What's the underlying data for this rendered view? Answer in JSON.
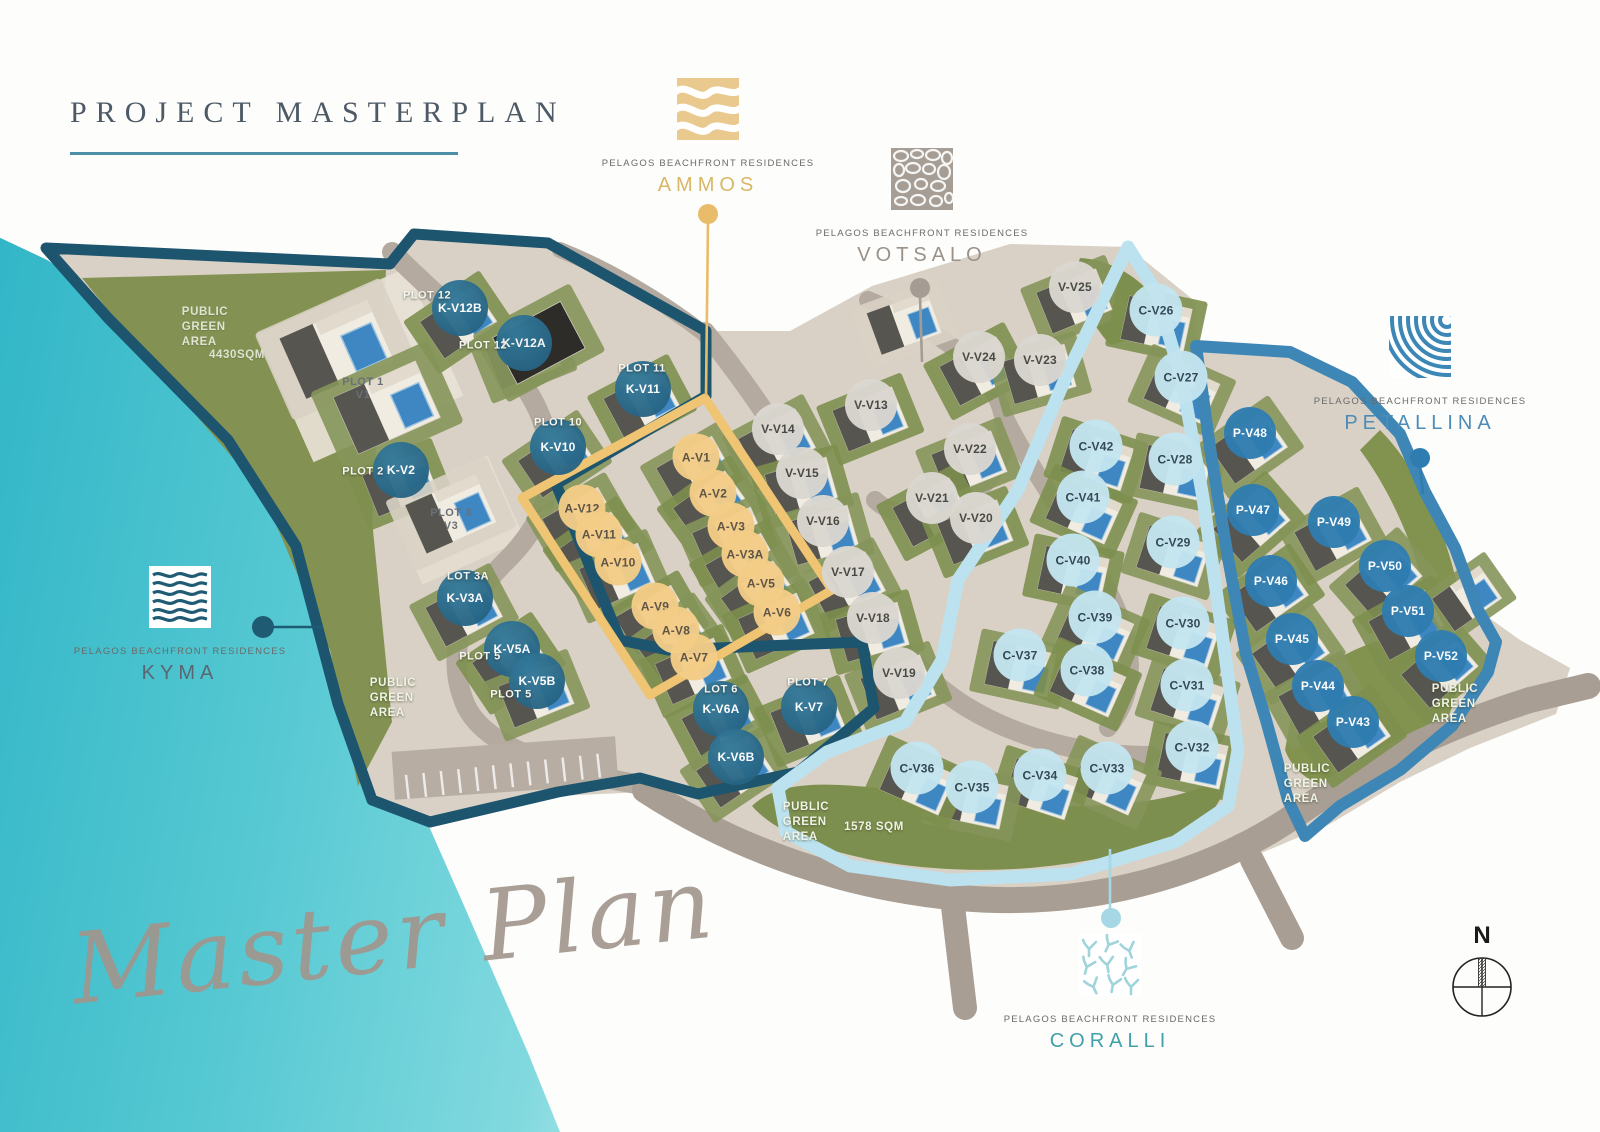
{
  "header": {
    "title": "PROJECT MASTERPLAN"
  },
  "watermark": {
    "script_text": "Master Plan"
  },
  "compass": {
    "label": "N"
  },
  "brand_subtitle": "PELAGOS BEACHFRONT RESIDENCES",
  "zone_callouts": [
    {
      "id": "ammos",
      "name": "AMMOS",
      "color": "#e9bc6a",
      "icon": "sand-waves-icon",
      "x": 708,
      "y": 78,
      "dot": {
        "x": 708,
        "y": 214
      },
      "line": {
        "x1": 708,
        "y1": 221,
        "x2": 706,
        "y2": 396
      }
    },
    {
      "id": "votsalo",
      "name": "VOTSALO",
      "color": "#a59c94",
      "icon": "pebbles-icon",
      "x": 922,
      "y": 148,
      "dot": {
        "x": 920,
        "y": 288
      },
      "line": {
        "x1": 920,
        "y1": 296,
        "x2": 922,
        "y2": 362
      }
    },
    {
      "id": "kyma",
      "name": "KYMA",
      "color": "#1f5b72",
      "icon": "sea-waves-icon",
      "x": 180,
      "y": 566,
      "dot": {
        "x": 263,
        "y": 627
      },
      "line": {
        "x1": 269,
        "y1": 627,
        "x2": 323,
        "y2": 627
      }
    },
    {
      "id": "petallina",
      "name": "PETALLINA",
      "color": "#2f7db0",
      "icon": "shell-fan-icon",
      "x": 1420,
      "y": 316,
      "dot": {
        "x": 1420,
        "y": 458
      },
      "line": {
        "x1": 1420,
        "y1": 466,
        "x2": 1423,
        "y2": 494
      }
    },
    {
      "id": "coralli",
      "name": "CORALLI",
      "color": "#a5d8e4",
      "icon": "coral-icon",
      "x": 1110,
      "y": 934,
      "dot": {
        "x": 1111,
        "y": 918
      },
      "line": {
        "x1": 1110,
        "y1": 910,
        "x2": 1110,
        "y2": 849
      }
    }
  ],
  "villas": [
    {
      "id": "K-V12B",
      "group": "kyma",
      "x": 460,
      "y": 308
    },
    {
      "id": "K-V12A",
      "group": "kyma",
      "x": 524,
      "y": 343
    },
    {
      "id": "K-V11",
      "group": "kyma",
      "x": 643,
      "y": 389
    },
    {
      "id": "K-V10",
      "group": "kyma",
      "x": 558,
      "y": 447
    },
    {
      "id": "K-V2",
      "group": "kyma",
      "x": 401,
      "y": 470
    },
    {
      "id": "K-V3A",
      "group": "kyma",
      "x": 465,
      "y": 598
    },
    {
      "id": "K-V5A",
      "group": "kyma",
      "x": 512,
      "y": 649
    },
    {
      "id": "K-V5B",
      "group": "kyma",
      "x": 537,
      "y": 681
    },
    {
      "id": "K-V6A",
      "group": "kyma",
      "x": 721,
      "y": 709
    },
    {
      "id": "K-V6B",
      "group": "kyma",
      "x": 736,
      "y": 757
    },
    {
      "id": "K-V7",
      "group": "kyma",
      "x": 809,
      "y": 707
    },
    {
      "id": "A-V1",
      "group": "ammos",
      "x": 696,
      "y": 457
    },
    {
      "id": "A-V2",
      "group": "ammos",
      "x": 713,
      "y": 493
    },
    {
      "id": "A-V3",
      "group": "ammos",
      "x": 731,
      "y": 526
    },
    {
      "id": "A-V3A",
      "group": "ammos",
      "x": 745,
      "y": 554
    },
    {
      "id": "A-V5",
      "group": "ammos",
      "x": 761,
      "y": 583
    },
    {
      "id": "A-V6",
      "group": "ammos",
      "x": 777,
      "y": 612
    },
    {
      "id": "A-V12",
      "group": "ammos",
      "x": 582,
      "y": 508
    },
    {
      "id": "A-V11",
      "group": "ammos",
      "x": 599,
      "y": 534
    },
    {
      "id": "A-V10",
      "group": "ammos",
      "x": 618,
      "y": 562
    },
    {
      "id": "A-V9",
      "group": "ammos",
      "x": 655,
      "y": 606
    },
    {
      "id": "A-V8",
      "group": "ammos",
      "x": 676,
      "y": 630
    },
    {
      "id": "A-V7",
      "group": "ammos",
      "x": 694,
      "y": 657
    },
    {
      "id": "V-V25",
      "group": "votsalo",
      "x": 1075,
      "y": 287
    },
    {
      "id": "V-V24",
      "group": "votsalo",
      "x": 979,
      "y": 357
    },
    {
      "id": "V-V23",
      "group": "votsalo",
      "x": 1040,
      "y": 360
    },
    {
      "id": "V-V13",
      "group": "votsalo",
      "x": 871,
      "y": 405
    },
    {
      "id": "V-V14",
      "group": "votsalo",
      "x": 778,
      "y": 429
    },
    {
      "id": "V-V15",
      "group": "votsalo",
      "x": 802,
      "y": 473
    },
    {
      "id": "V-V22",
      "group": "votsalo",
      "x": 970,
      "y": 449
    },
    {
      "id": "V-V21",
      "group": "votsalo",
      "x": 932,
      "y": 498
    },
    {
      "id": "V-V16",
      "group": "votsalo",
      "x": 823,
      "y": 521
    },
    {
      "id": "V-V20",
      "group": "votsalo",
      "x": 976,
      "y": 518
    },
    {
      "id": "V-V17",
      "group": "votsalo",
      "x": 848,
      "y": 572
    },
    {
      "id": "V-V18",
      "group": "votsalo",
      "x": 873,
      "y": 618
    },
    {
      "id": "V-V19",
      "group": "votsalo",
      "x": 899,
      "y": 673
    },
    {
      "id": "C-V26",
      "group": "coralli",
      "x": 1156,
      "y": 310
    },
    {
      "id": "C-V27",
      "group": "coralli",
      "x": 1181,
      "y": 377
    },
    {
      "id": "C-V42",
      "group": "coralli",
      "x": 1096,
      "y": 446
    },
    {
      "id": "C-V28",
      "group": "coralli",
      "x": 1175,
      "y": 459
    },
    {
      "id": "C-V41",
      "group": "coralli",
      "x": 1083,
      "y": 497
    },
    {
      "id": "C-V29",
      "group": "coralli",
      "x": 1173,
      "y": 542
    },
    {
      "id": "C-V40",
      "group": "coralli",
      "x": 1073,
      "y": 560
    },
    {
      "id": "C-V39",
      "group": "coralli",
      "x": 1095,
      "y": 617
    },
    {
      "id": "C-V30",
      "group": "coralli",
      "x": 1183,
      "y": 623
    },
    {
      "id": "C-V37",
      "group": "coralli",
      "x": 1020,
      "y": 655
    },
    {
      "id": "C-V38",
      "group": "coralli",
      "x": 1087,
      "y": 670
    },
    {
      "id": "C-V31",
      "group": "coralli",
      "x": 1187,
      "y": 685
    },
    {
      "id": "C-V32",
      "group": "coralli",
      "x": 1192,
      "y": 747
    },
    {
      "id": "C-V33",
      "group": "coralli",
      "x": 1107,
      "y": 768
    },
    {
      "id": "C-V34",
      "group": "coralli",
      "x": 1040,
      "y": 775
    },
    {
      "id": "C-V35",
      "group": "coralli",
      "x": 972,
      "y": 787
    },
    {
      "id": "C-V36",
      "group": "coralli",
      "x": 917,
      "y": 768
    },
    {
      "id": "P-V48",
      "group": "petallina",
      "x": 1250,
      "y": 433
    },
    {
      "id": "P-V47",
      "group": "petallina",
      "x": 1253,
      "y": 510
    },
    {
      "id": "P-V49",
      "group": "petallina",
      "x": 1334,
      "y": 522
    },
    {
      "id": "P-V46",
      "group": "petallina",
      "x": 1271,
      "y": 581
    },
    {
      "id": "P-V50",
      "group": "petallina",
      "x": 1385,
      "y": 566
    },
    {
      "id": "P-V51",
      "group": "petallina",
      "x": 1408,
      "y": 611
    },
    {
      "id": "P-V45",
      "group": "petallina",
      "x": 1292,
      "y": 639
    },
    {
      "id": "P-V52",
      "group": "petallina",
      "x": 1441,
      "y": 656
    },
    {
      "id": "P-V44",
      "group": "petallina",
      "x": 1318,
      "y": 686
    },
    {
      "id": "P-V43",
      "group": "petallina",
      "x": 1353,
      "y": 722
    }
  ],
  "plot_labels": [
    {
      "lines": [
        "PLOT 12"
      ],
      "x": 427,
      "y": 296,
      "tone": "white"
    },
    {
      "lines": [
        "PLOT 12"
      ],
      "x": 483,
      "y": 346,
      "tone": "white"
    },
    {
      "lines": [
        "PLOT 11"
      ],
      "x": 642,
      "y": 369,
      "tone": "white"
    },
    {
      "lines": [
        "PLOT 10"
      ],
      "x": 558,
      "y": 423,
      "tone": "white"
    },
    {
      "lines": [
        "PLOT 1",
        "V1"
      ],
      "x": 363,
      "y": 389,
      "tone": "gray"
    },
    {
      "lines": [
        "PLOT 2"
      ],
      "x": 363,
      "y": 472,
      "tone": "white"
    },
    {
      "lines": [
        "PLOT 3",
        "V3"
      ],
      "x": 451,
      "y": 520,
      "tone": "gray"
    },
    {
      "lines": [
        "LOT 3A"
      ],
      "x": 468,
      "y": 577,
      "tone": "white"
    },
    {
      "lines": [
        "PLOT 5"
      ],
      "x": 480,
      "y": 657,
      "tone": "white"
    },
    {
      "lines": [
        "PLOT 5"
      ],
      "x": 511,
      "y": 695,
      "tone": "white"
    },
    {
      "lines": [
        "LOT 6"
      ],
      "x": 721,
      "y": 690,
      "tone": "white"
    },
    {
      "lines": [
        "PLOT 7"
      ],
      "x": 808,
      "y": 683,
      "tone": "white"
    }
  ],
  "area_labels": [
    {
      "lines": [
        "PUBLIC",
        "GREEN",
        "AREA"
      ],
      "x": 205,
      "y": 305,
      "tone": "muted"
    },
    {
      "lines": [
        "4430SQM"
      ],
      "x": 237,
      "y": 348,
      "tone": "muted"
    },
    {
      "lines": [
        "PUBLIC",
        "GREEN",
        "AREA"
      ],
      "x": 393,
      "y": 676,
      "tone": "white"
    },
    {
      "lines": [
        "PUBLIC",
        "GREEN",
        "AREA"
      ],
      "x": 806,
      "y": 800,
      "tone": "white"
    },
    {
      "lines": [
        "1578 SQM"
      ],
      "x": 874,
      "y": 820,
      "tone": "white"
    },
    {
      "lines": [
        "PUBLIC",
        "GREEN",
        "AREA"
      ],
      "x": 1307,
      "y": 762,
      "tone": "white"
    },
    {
      "lines": [
        "PUBLIC",
        "GREEN",
        "AREA"
      ],
      "x": 1455,
      "y": 682,
      "tone": "white"
    }
  ],
  "extra_buildings": [
    {
      "x": 338,
      "y": 352,
      "a": -24,
      "s": 1.5
    },
    {
      "x": 388,
      "y": 410,
      "a": -24,
      "s": 1.4
    },
    {
      "x": 452,
      "y": 516,
      "a": -24,
      "s": 1.2
    },
    {
      "x": 540,
      "y": 345,
      "a": -28,
      "s": 1.2,
      "dark": true
    },
    {
      "x": 905,
      "y": 325,
      "a": -20,
      "s": 1.0
    },
    {
      "x": 1468,
      "y": 600,
      "a": -35,
      "s": 0.9
    }
  ]
}
